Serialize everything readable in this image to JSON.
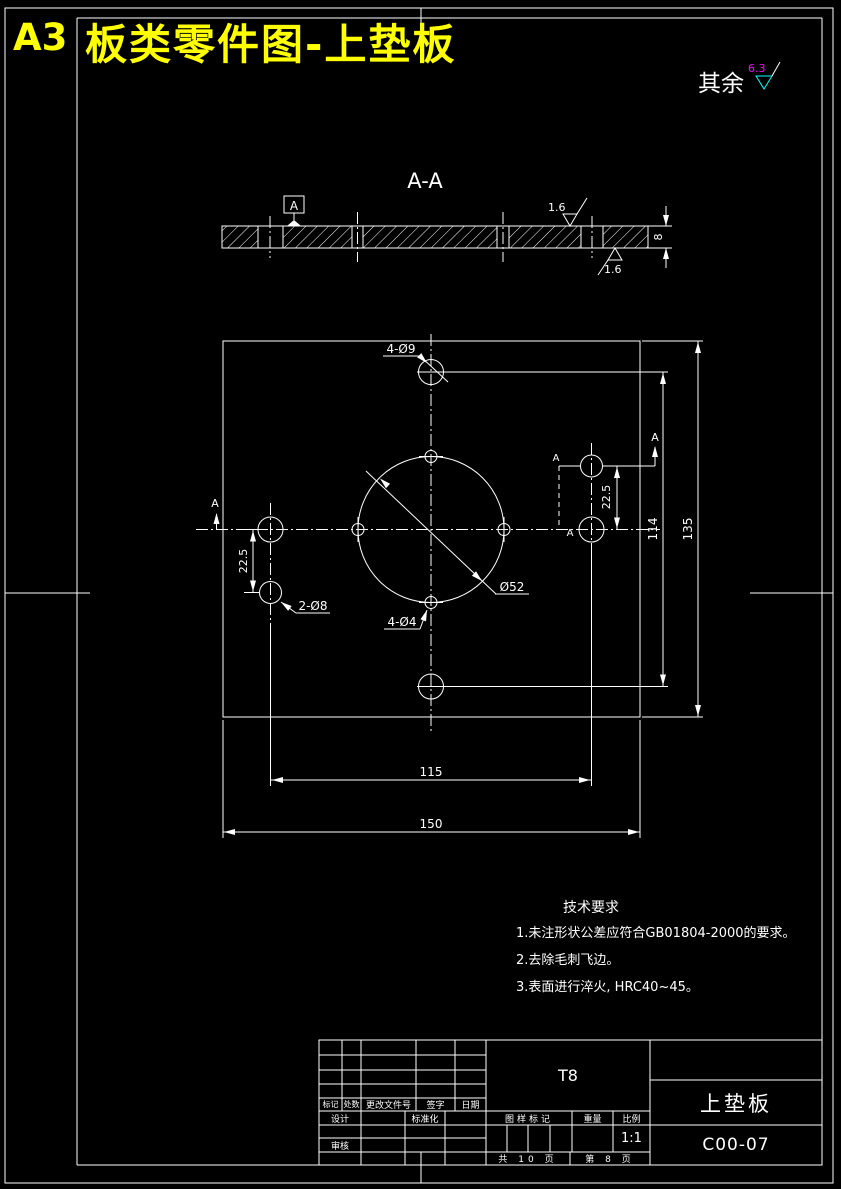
{
  "colors": {
    "background": "#000000",
    "line": "#ffffff",
    "title": "#ffff00",
    "roughness_value": "#ff00ff",
    "roughness_symbol": "#00ffff"
  },
  "sheet": {
    "size_label": "A3",
    "title": "板类零件图-上垫板"
  },
  "surface_note": {
    "label": "其余",
    "value": "6.3"
  },
  "section": {
    "title": "A-A",
    "datum": "A",
    "rough_top": "1.6",
    "rough_bottom": "1.6",
    "thickness": "8"
  },
  "plan": {
    "marker": "A",
    "label_4d9": "4-Ø9",
    "label_2d8": "2-Ø8",
    "label_4d4": "4-Ø4",
    "label_d52": "Ø52",
    "dim_22_5": "22.5",
    "dim_114": "114",
    "dim_135": "135",
    "dim_115": "115",
    "dim_150": "150"
  },
  "tech": {
    "title": "技术要求",
    "items": [
      "1.未注形状公差应符合GB01804-2000的要求。",
      "2.去除毛刺飞边。",
      "3.表面进行淬火, HRC40~45。"
    ]
  },
  "tb": {
    "material": "T8",
    "part": "上垫板",
    "dwg_no": "C00-07",
    "scale_val": "1:1",
    "mark": "标记",
    "count": "处数",
    "change": "更改文件号",
    "sign": "签字",
    "date": "日期",
    "design": "设计",
    "standard": "标准化",
    "review": "审核",
    "stage": "图样标记",
    "weight": "重量",
    "scale": "比例",
    "total_pages": "共 10 页",
    "page_no": "第 8 页"
  }
}
